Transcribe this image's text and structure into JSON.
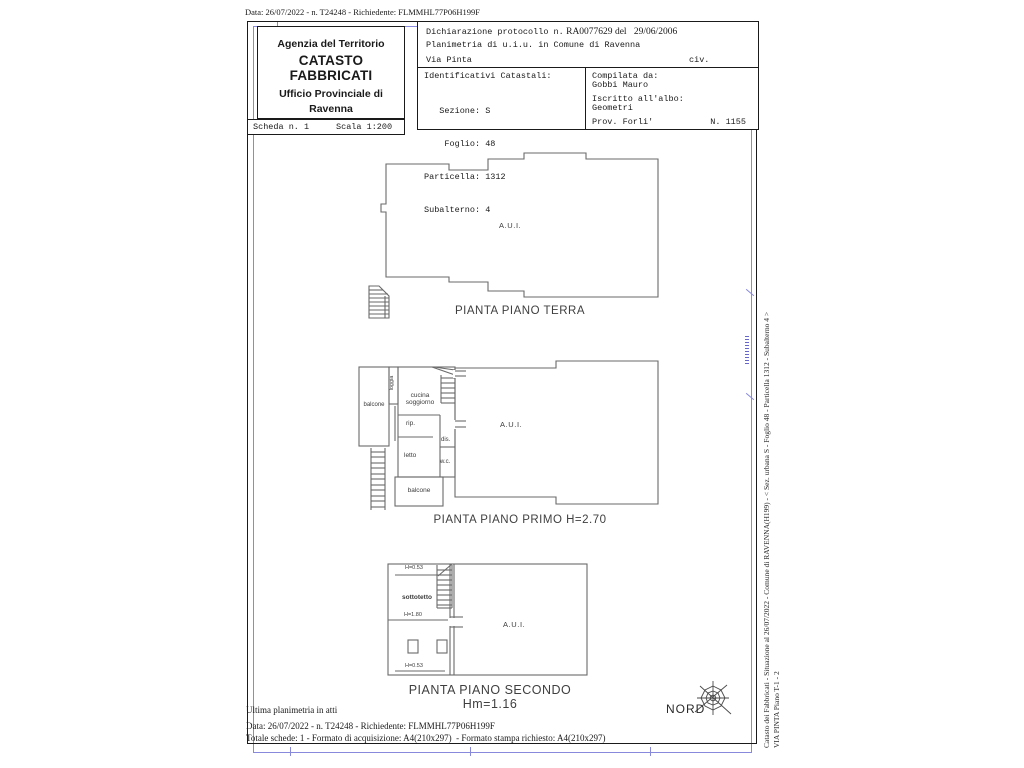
{
  "meta": {
    "top_line": "Data: 26/07/2022 - n. T24248 - Richiedente: FLMMHL77P06H199F"
  },
  "header": {
    "agency": {
      "line1": "Agenzia del Territorio",
      "line2": "CATASTO FABBRICATI",
      "line3": "Ufficio Provinciale di",
      "line4": "Ravenna"
    },
    "scheda": {
      "number": "Scheda n. 1",
      "scale": "Scala 1:200"
    },
    "declaration": {
      "protocol_label": "Dichiarazione protocollo n.",
      "protocol_number": "RA0077629",
      "protocol_del": "del",
      "protocol_date": "29/06/2006",
      "line2": "Planimetria di u.i.u. in Comune di Ravenna",
      "street": "Via Pinta",
      "civ": "civ."
    },
    "identificativi": {
      "title": "Identificativi Catastali:",
      "rows": [
        "   Sezione: S",
        "    Foglio: 48",
        "Particella: 1312",
        "Subalterno: 4"
      ]
    },
    "compilata": {
      "label": "Compilata da:",
      "name": "Gobbi Mauro",
      "albo_label": "Iscritto all'albo:",
      "albo_value": "Geometri",
      "prov": "Prov. Forli'",
      "num": "N. 1155"
    }
  },
  "plans": {
    "terra": {
      "aui": "A.U.I.",
      "caption": "PIANTA PIANO TERRA"
    },
    "primo": {
      "caption": "PIANTA PIANO PRIMO H=2.70",
      "balcone_left": "balcone",
      "loggia": "loggia",
      "cucina_line1": "cucina",
      "cucina_line2": "soggiorno",
      "rip": "rip.",
      "dis": "dis.",
      "letto": "letto",
      "wc": "w.c.",
      "balcone_bottom": "balcone",
      "aui": "A.U.I."
    },
    "secondo": {
      "caption": "PIANTA PIANO SECONDO Hm=1.16",
      "h_top": "H=0.53",
      "sottotetto": "sottotetto",
      "h_mid": "H=1.80",
      "h_bottom": "H=0.53",
      "aui": "A.U.I."
    }
  },
  "footer": {
    "ultima": "Ultima planimetria in atti",
    "data_line": "Data: 26/07/2022 - n. T24248 - Richiedente: FLMMHL77P06H199F",
    "totale": "Totale schede: 1 - Formato di acquisizione: A4(210x297)  - Formato stampa richiesto: A4(210x297)",
    "nord": "NORD"
  },
  "sidebar": {
    "line1": "Catasto dei Fabbricati - Situazione al 26/07/2022 - Comune di RAVENNA(H199) - < Sez. urbana S -  Foglio 48 - Particella  1312 - Subalterno 4 >",
    "line2": "VIA PINTA Piano T-1 - 2"
  },
  "colors": {
    "frame": "#1a1a1a",
    "plan_line": "#6a6a6a",
    "registration_blue": "#8888dd"
  }
}
